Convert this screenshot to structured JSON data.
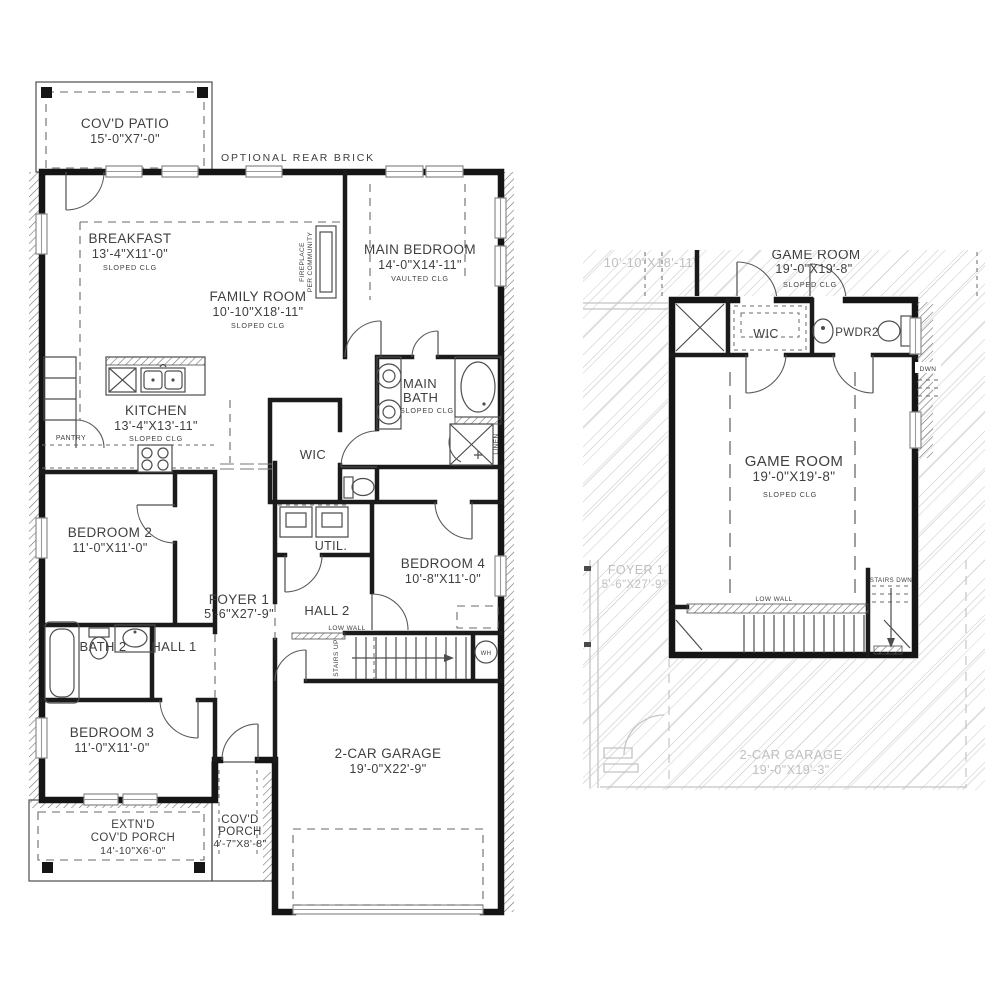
{
  "colors": {
    "wall": "#151515",
    "text": "#3f3f3f",
    "ghost": "#c0c0c0",
    "hatch_light": "#cdcdcd",
    "hatch_dark": "#6f6f6f",
    "background": "#ffffff"
  },
  "floor1": {
    "optional_rear_brick": "OPTIONAL  REAR  BRICK",
    "covd_patio_name": "COV'D PATIO",
    "covd_patio_dims": "15'-0\"X7'-0\"",
    "breakfast_name": "BREAKFAST",
    "breakfast_dims": "13'-4\"X11'-0\"",
    "breakfast_clg": "SLOPED  CLG",
    "family_name": "FAMILY ROOM",
    "family_dims": "10'-10\"X18'-11\"",
    "family_clg": "SLOPED  CLG",
    "fireplace_note_1": "FIREPLACE",
    "fireplace_note_2": "PER  COMMUNITY",
    "main_bedroom_name": "MAIN BEDROOM",
    "main_bedroom_dims": "14'-0\"X14'-11\"",
    "main_bedroom_clg": "VAULTED  CLG",
    "kitchen_name": "KITCHEN",
    "kitchen_dims": "13'-4\"X13'-11\"",
    "kitchen_clg": "SLOPED  CLG",
    "pantry": "PANTRY",
    "main_bath_1": "MAIN",
    "main_bath_2": "BATH",
    "main_bath_clg": "SLOPED  CLG",
    "wic": "WIC",
    "linen": "LINEN",
    "bedroom2_name": "BEDROOM 2",
    "bedroom2_dims": "11'-0\"X11'-0\"",
    "util": "UTIL.",
    "bedroom4_name": "BEDROOM 4",
    "bedroom4_dims": "10'-8\"X11'-0\"",
    "foyer_name": "FOYER 1",
    "foyer_dims": "5'-6\"X27'-9\"",
    "hall1": "HALL 1",
    "hall2": "HALL 2",
    "bath2": "BATH 2",
    "low_wall": "LOW  WALL",
    "stairs_up": "STAIRS  UP",
    "wh": "WH",
    "bedroom3_name": "BEDROOM 3",
    "bedroom3_dims": "11'-0\"X11'-0\"",
    "garage_name": "2-CAR GARAGE",
    "garage_dims": "19'-0\"X22'-9\"",
    "extnd_porch_1": "EXTN'D",
    "extnd_porch_2": "COV'D PORCH",
    "extnd_porch_dims": "14'-10\"X6'-0\"",
    "covd_porch_1": "COV'D",
    "covd_porch_2": "PORCH",
    "covd_porch_dims": "4'-7\"X8'-8\""
  },
  "floor2": {
    "clipped_name": "GAME ROOM",
    "clipped_dims": "19'-0\"X19'-8\"",
    "clipped_clg": "SLOPED  CLG",
    "ghost_family_dims": "10'-10\"X18'-11\"",
    "wic": "WIC",
    "pwdr2": "PWDR2",
    "dwn": "DWN",
    "game_room_name": "GAME ROOM",
    "game_room_dims": "19'-0\"X19'-8\"",
    "game_room_clg": "SLOPED  CLG",
    "ghost_foyer_name": "FOYER 1",
    "ghost_foyer_dims": "5'-6\"X27'-9\"",
    "low_wall": "LOW  WALL",
    "stairs_dwn": "STAIRS  DWN",
    "ghost_garage_name": "2-CAR GARAGE",
    "ghost_garage_dims": "19'-0\"X19'-3\""
  }
}
